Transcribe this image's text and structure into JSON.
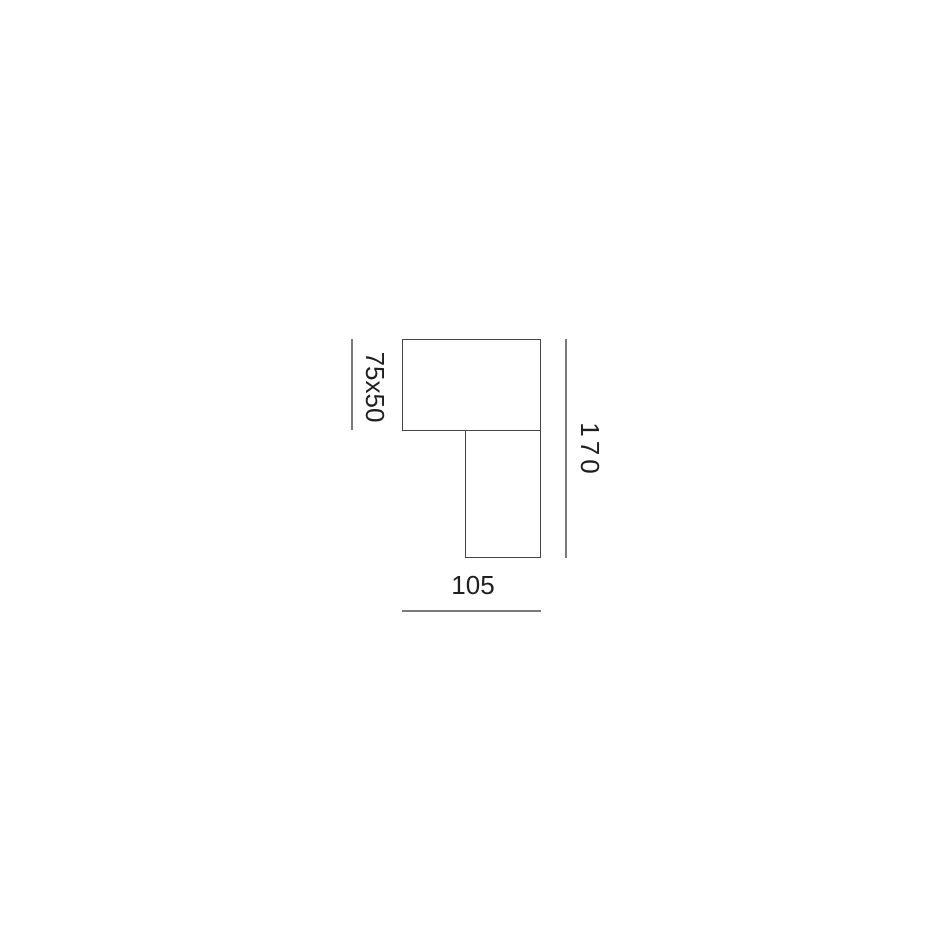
{
  "colors": {
    "background": "#ffffff",
    "outline": "#454545",
    "dimension-line": "#7a7a7a",
    "label-text": "#1f1f1f"
  },
  "drawing": {
    "labels": {
      "shade_dimension": "75x50",
      "height_dimension": "170",
      "width_dimension": "105"
    }
  }
}
